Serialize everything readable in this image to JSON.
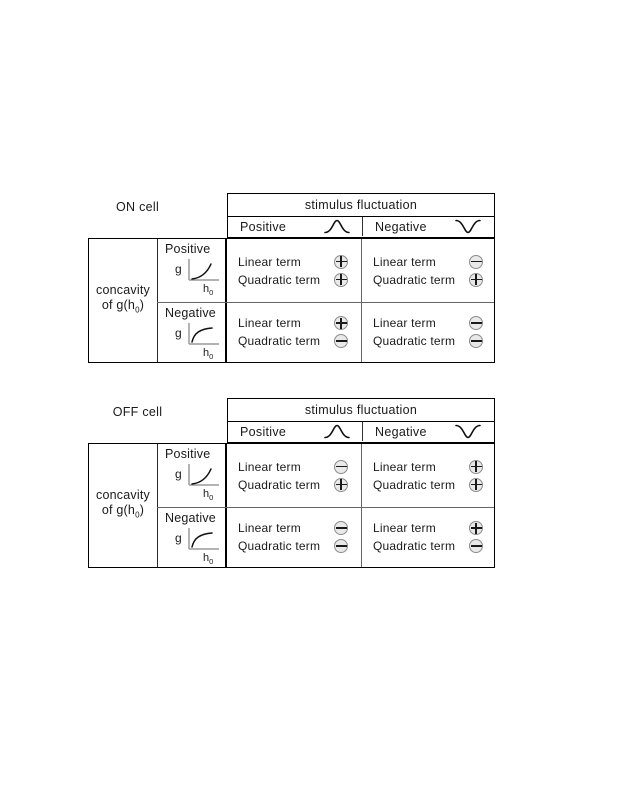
{
  "labels": {
    "linear": "Linear term",
    "quadratic": "Quadratic term",
    "g": "g",
    "h": "h",
    "h_sub": "0"
  },
  "colors": {
    "background": "#ffffff",
    "line": "#000000",
    "axis_gray": "#9a9a9a",
    "circle_fill": "#e9e9e9",
    "circle_border": "#8c8c8c",
    "text": "#1a1a1a"
  },
  "tables": [
    {
      "label": "ON cell",
      "header": {
        "title": "stimulus fluctuation",
        "columns": [
          {
            "label": "Positive",
            "icon": "bump-curve-icon"
          },
          {
            "label": "Negative",
            "icon": "dip-curve-icon"
          }
        ]
      },
      "side": {
        "line1": "concavity",
        "line2_pre": "of g(h",
        "line2_sub": "0",
        "line2_post": ")"
      },
      "rows": [
        {
          "label": "Positive",
          "curve_icon": "convex-increasing-curve-icon",
          "cells": [
            {
              "linear": "plus",
              "quadratic": "plus"
            },
            {
              "linear": "minus",
              "quadratic": "plus"
            }
          ]
        },
        {
          "label": "Negative",
          "curve_icon": "concave-increasing-curve-icon",
          "cells": [
            {
              "linear": "plus",
              "quadratic": "minus"
            },
            {
              "linear": "minus",
              "quadratic": "minus"
            }
          ]
        }
      ]
    },
    {
      "label": "OFF cell",
      "header": {
        "title": "stimulus fluctuation",
        "columns": [
          {
            "label": "Positive",
            "icon": "bump-curve-icon"
          },
          {
            "label": "Negative",
            "icon": "dip-curve-icon"
          }
        ]
      },
      "side": {
        "line1": "concavity",
        "line2_pre": "of g(h",
        "line2_sub": "0",
        "line2_post": ")"
      },
      "rows": [
        {
          "label": "Positive",
          "curve_icon": "convex-increasing-curve-icon",
          "cells": [
            {
              "linear": "minus",
              "quadratic": "plus"
            },
            {
              "linear": "plus",
              "quadratic": "plus"
            }
          ]
        },
        {
          "label": "Negative",
          "curve_icon": "concave-increasing-curve-icon",
          "cells": [
            {
              "linear": "minus",
              "quadratic": "minus"
            },
            {
              "linear": "plus",
              "quadratic": "minus"
            }
          ]
        }
      ]
    }
  ]
}
